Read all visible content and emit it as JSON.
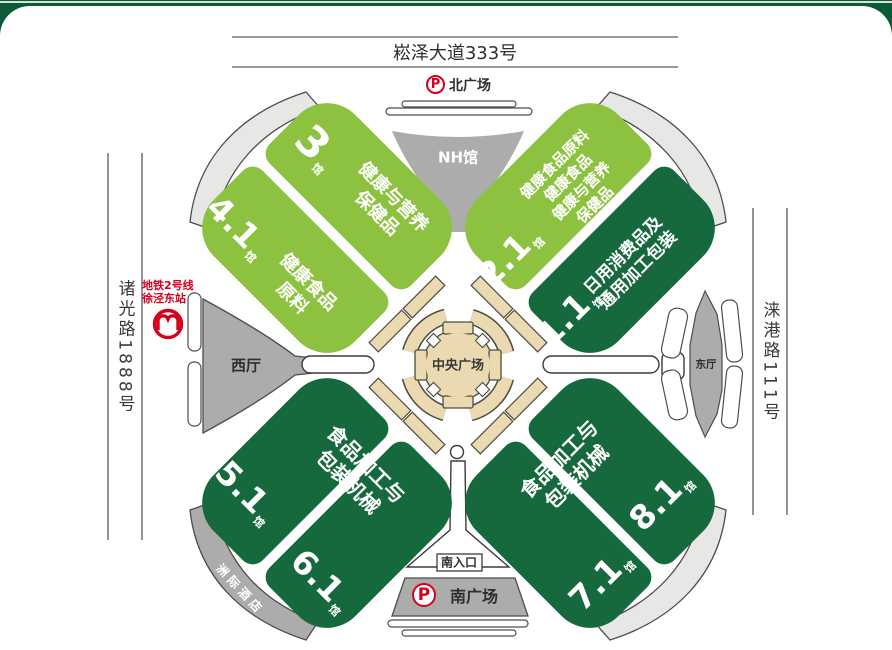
{
  "roads": {
    "north": "崧泽大道333号",
    "west": "诸光路1888号",
    "east": "涞港路111号"
  },
  "plazas": {
    "north": "北广场",
    "south": "南广场",
    "central": "中央广场",
    "entrance_south": "南入口"
  },
  "parking": {
    "symbol": "P"
  },
  "metro": {
    "line": "地铁2号线",
    "station": "徐泾东站"
  },
  "venues": {
    "nh": "NH馆",
    "west_hall": "西厅",
    "east_hall": "东厅",
    "hotel": "洲际酒店"
  },
  "halls": {
    "h3": {
      "number": "3",
      "suffix": "馆",
      "lines": [
        "健康与营养",
        "保健品"
      ]
    },
    "h41": {
      "number": "4.1",
      "suffix": "馆",
      "lines": [
        "健康食品",
        "原料"
      ]
    },
    "h21": {
      "number": "2.1",
      "suffix": "馆",
      "lines": [
        "健康食品原料",
        "健康食品",
        "健康与营养",
        "保健品"
      ]
    },
    "h11": {
      "number": "1.1",
      "suffix": "馆",
      "lines": [
        "日用消费品及",
        "通用加工包装"
      ]
    },
    "h51": {
      "number": "5.1",
      "suffix": "馆"
    },
    "h61": {
      "number": "6.1",
      "suffix": "馆"
    },
    "h71": {
      "number": "7.1",
      "suffix": "馆"
    },
    "h81": {
      "number": "8.1",
      "suffix": "馆"
    }
  },
  "groups": {
    "sw": {
      "lines": [
        "食品加工与",
        "包装机械"
      ]
    },
    "se": {
      "lines": [
        "食品加工与",
        "包装机械"
      ]
    }
  },
  "colors": {
    "light_green": "#8CC23F",
    "dark_green": "#15693C",
    "tan": "#EBD9B2",
    "gray": "#ACACAA",
    "light_gray": "#E7E7E5",
    "frame_green": "#0B5B36",
    "red": "#D6001C"
  }
}
